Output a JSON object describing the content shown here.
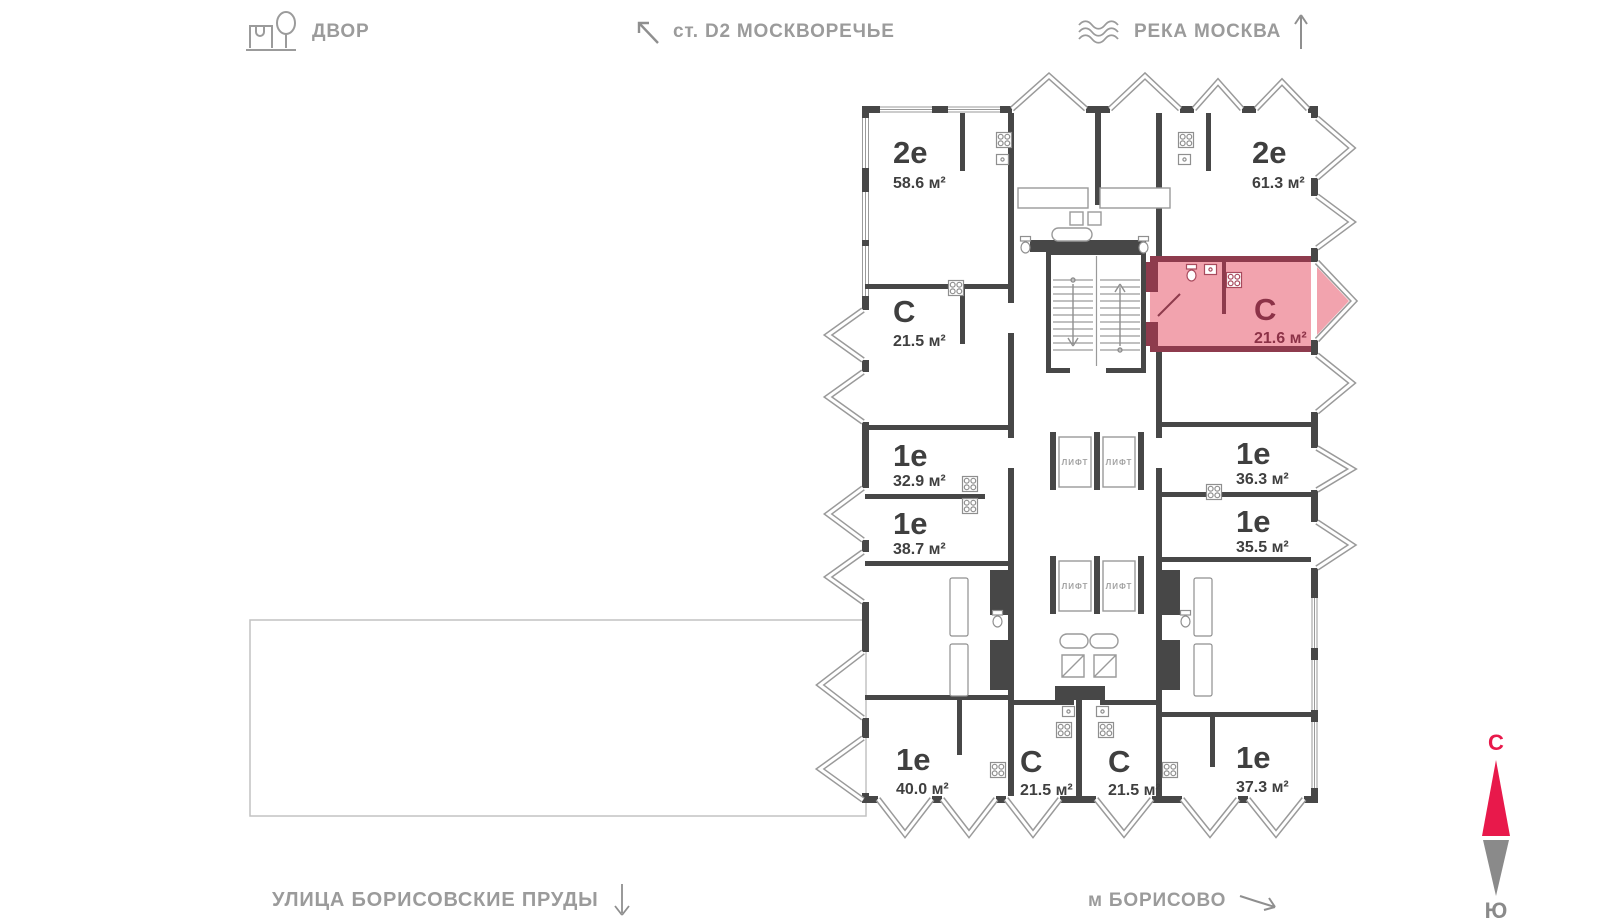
{
  "legend": {
    "courtyard": "ДВОР",
    "station": "ст. D2 МОСКВОРЕЧЬЕ",
    "river": "РЕКА МОСКВА",
    "street": "УЛИЦА БОРИСОВСКИЕ ПРУДЫ",
    "metro": "м БОРИСОВО"
  },
  "icons": {
    "courtyard": "house-tree-icon",
    "station": "arrow-up-left-icon",
    "river": "waves-icon",
    "river_direction": "arrow-up-icon",
    "street_direction": "arrow-down-icon",
    "metro_direction": "arrow-down-right-icon"
  },
  "compass": {
    "north": "С",
    "south": "Ю"
  },
  "plan": {
    "elevator_label": "ЛИФТ",
    "colors": {
      "wall": "#474747",
      "line": "#9a9a9a",
      "highlight_fill": "#f2a3ae",
      "highlight_wall": "#8e3b4d",
      "highlight_text": "#8c3247",
      "accent_red": "#e8194b"
    },
    "apartments": [
      {
        "type": "2е",
        "area": "58.6 м²"
      },
      {
        "type": "С",
        "area": "21.5 м²"
      },
      {
        "type": "1е",
        "area": "32.9 м²"
      },
      {
        "type": "1е",
        "area": "38.7 м²"
      },
      {
        "type": "1е",
        "area": "40.0 м²"
      },
      {
        "type": "С",
        "area": "21.5 м²"
      },
      {
        "type": "С",
        "area": "21.5 м²"
      },
      {
        "type": "1е",
        "area": "37.3 м²"
      },
      {
        "type": "1е",
        "area": "35.5 м²"
      },
      {
        "type": "1е",
        "area": "36.3 м²"
      },
      {
        "type": "С",
        "area": "21.6 м²",
        "highlighted": true
      },
      {
        "type": "2е",
        "area": "61.3 м²"
      }
    ]
  }
}
